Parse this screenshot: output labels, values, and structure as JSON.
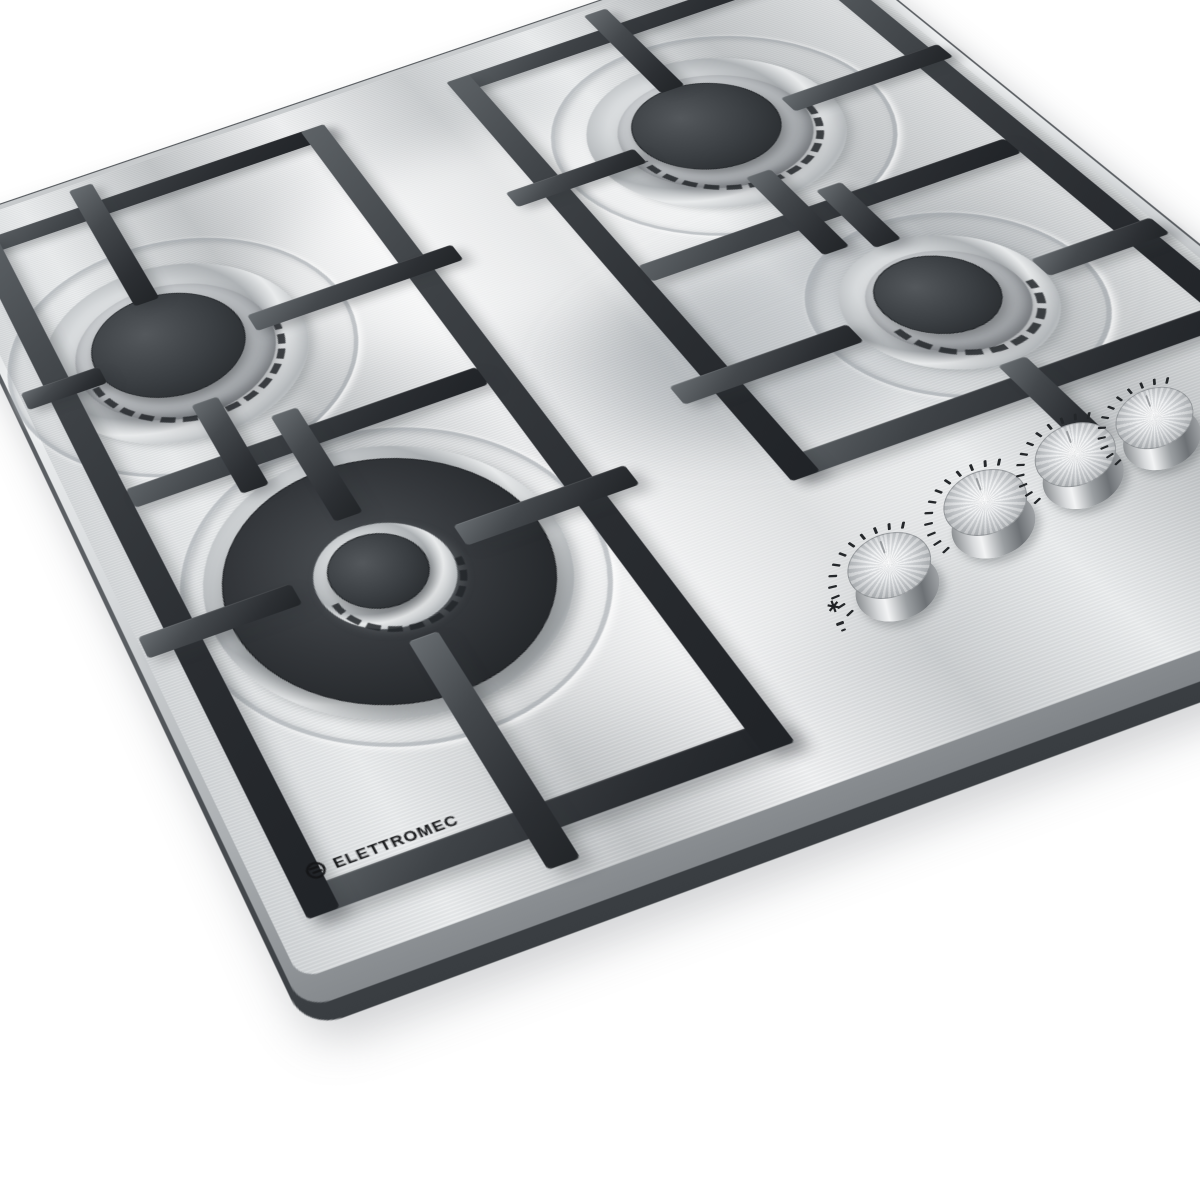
{
  "brand": {
    "name": "ELETTROMEC"
  },
  "appliance": {
    "description": "4-burner stainless steel gas cooktop",
    "burner_count": 4,
    "knob_count": 4
  },
  "burners": [
    {
      "label": "back-left burner",
      "size": "standard"
    },
    {
      "label": "back-right burner",
      "size": "standard"
    },
    {
      "label": "right small burner",
      "size": "auxiliary"
    },
    {
      "label": "front large burner",
      "size": "triple-ring"
    }
  ],
  "knobs": {
    "labels": [
      "knob-1",
      "knob-2",
      "knob-3",
      "knob-4"
    ],
    "dial": {
      "tick_count": 12,
      "start_angle": 150,
      "end_angle": 295,
      "radius": 62
    },
    "ignition_symbol": "∗"
  },
  "colors": {
    "background": "#ffffff",
    "steel_light": "#f4f5f6",
    "steel_mid": "#d3d6d8",
    "steel_dark": "#aeb3b6",
    "grate": "#2e3236",
    "burner_cap": "#2b2e32",
    "logo_ink": "#141517"
  }
}
